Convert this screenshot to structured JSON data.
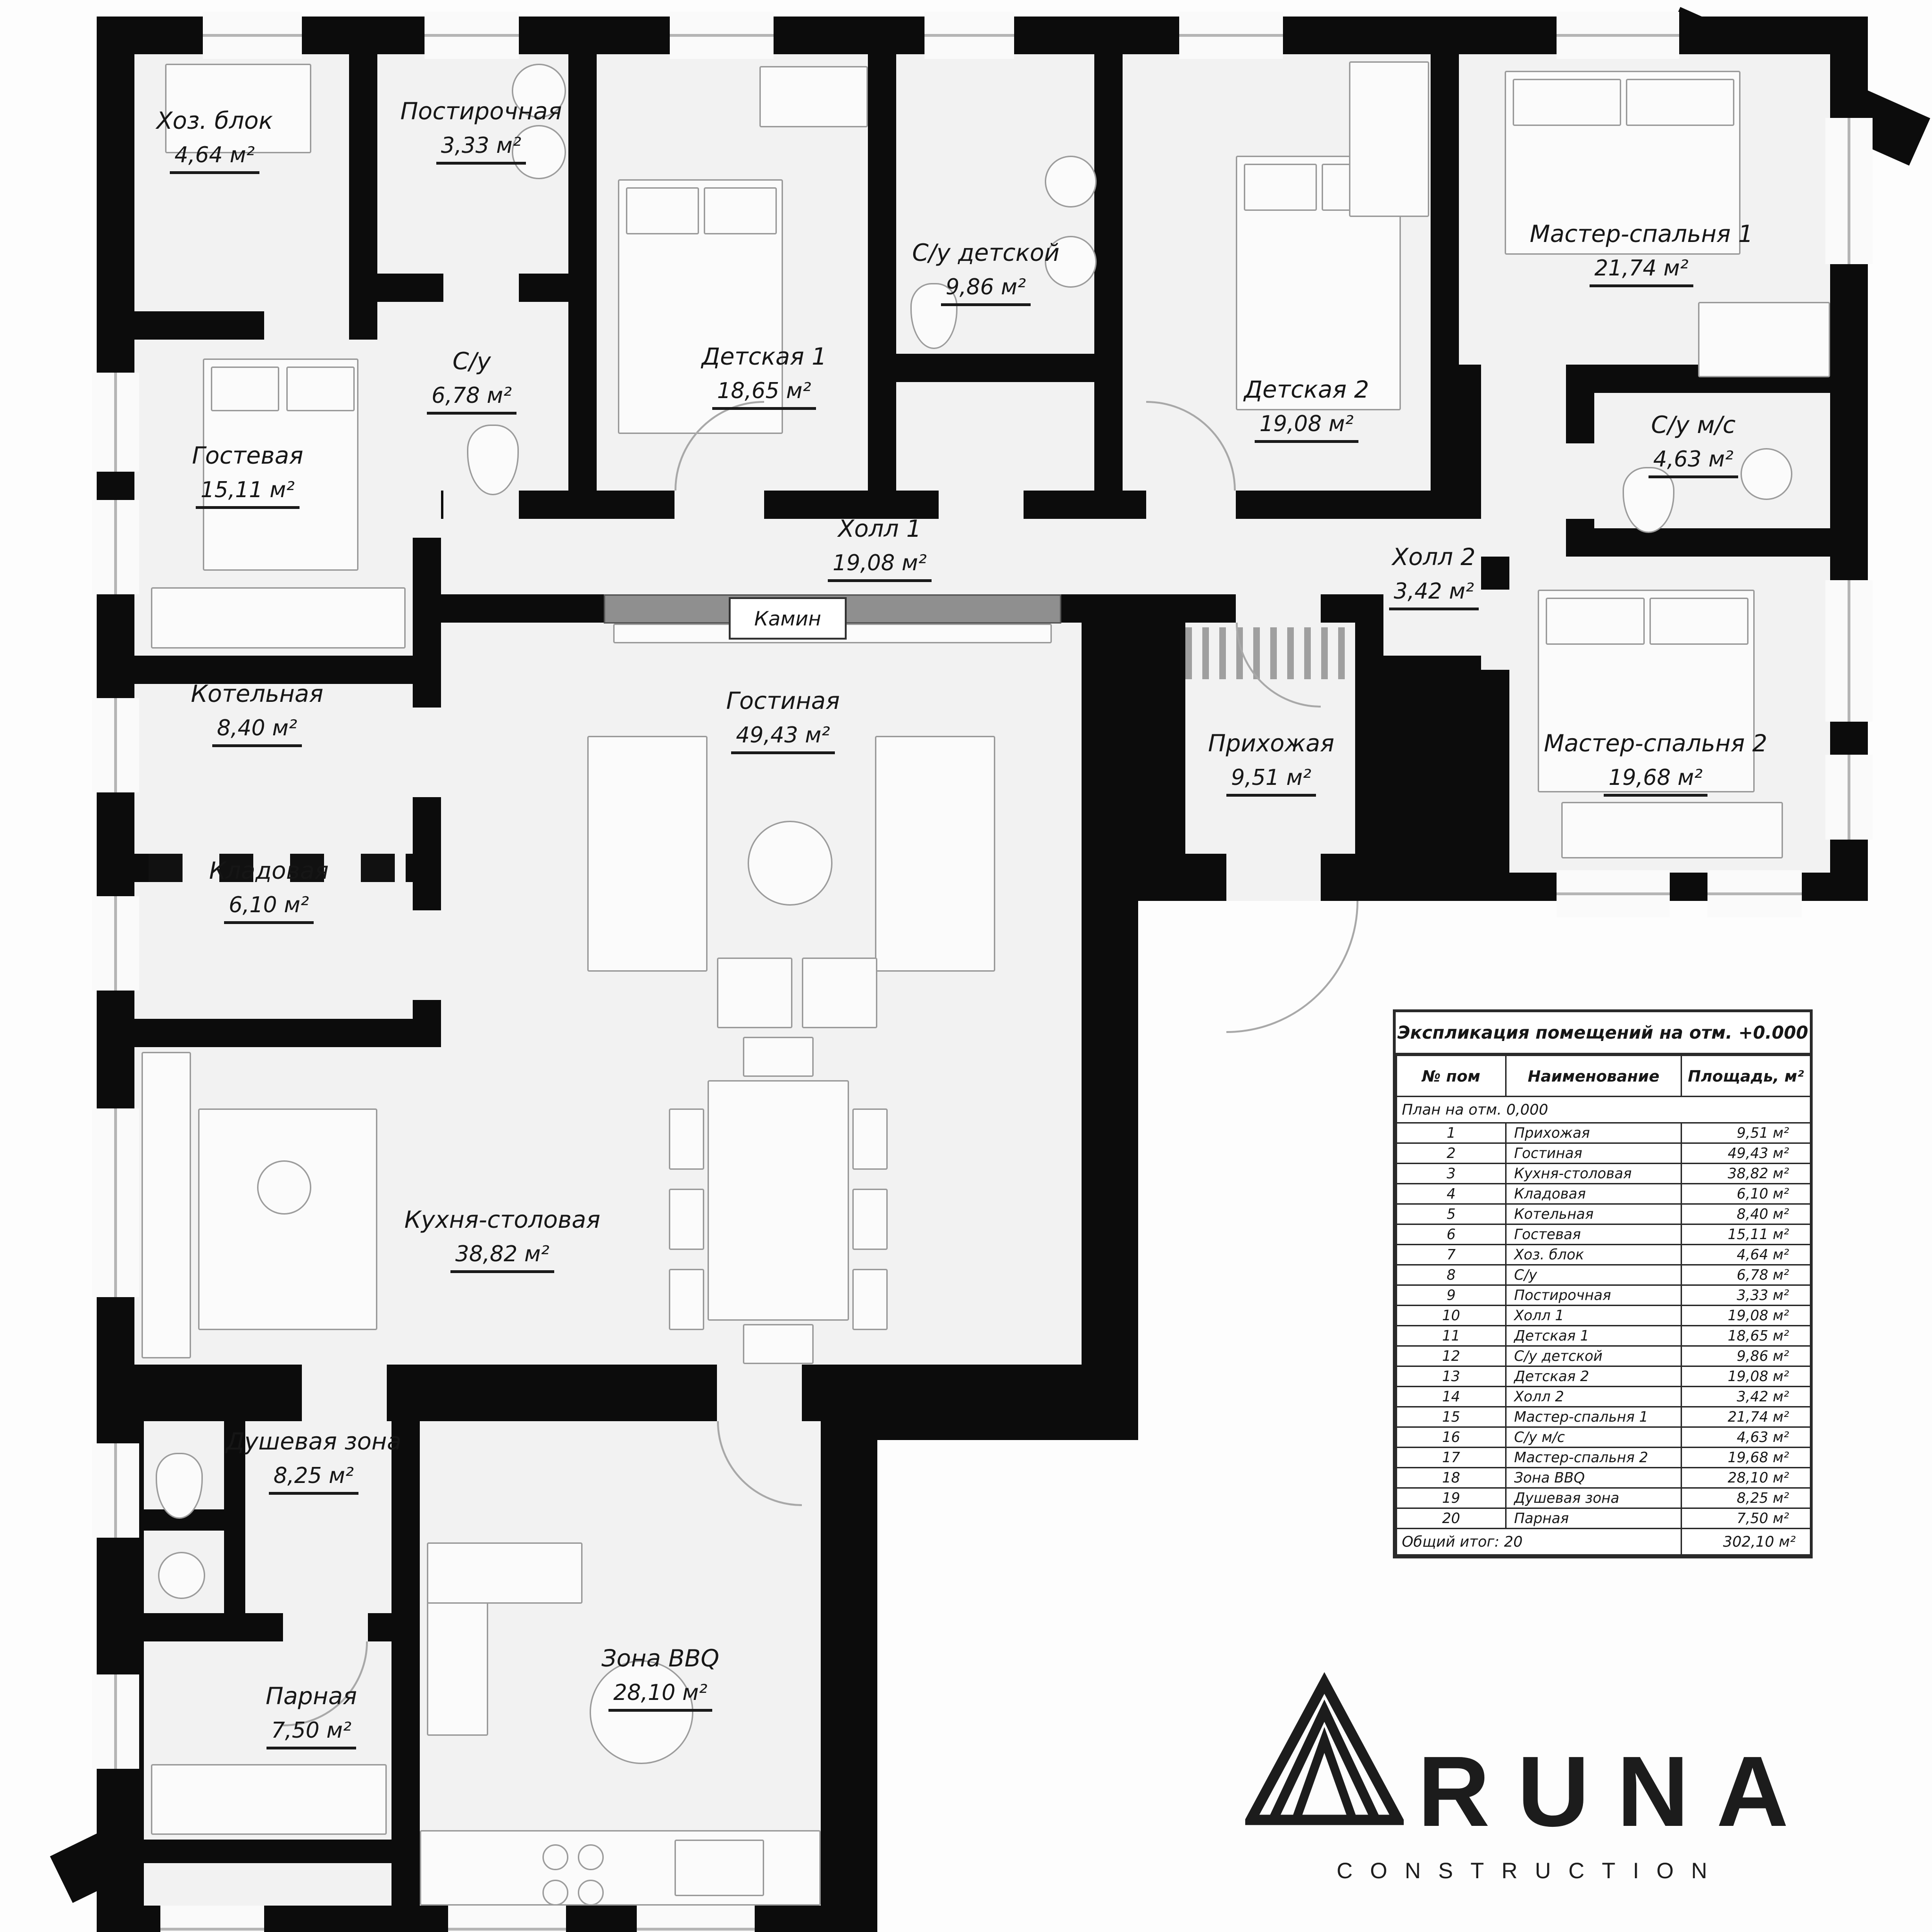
{
  "plan": {
    "fireplace_label": "Камин",
    "rooms": [
      {
        "id": "hoz",
        "name": "Хоз. блок",
        "area": "4,64 м²"
      },
      {
        "id": "post",
        "name": "Постирочная",
        "area": "3,33 м²"
      },
      {
        "id": "su",
        "name": "С/у",
        "area": "6,78 м²"
      },
      {
        "id": "det1",
        "name": "Детская 1",
        "area": "18,65 м²"
      },
      {
        "id": "sudet",
        "name": "С/у детской",
        "area": "9,86 м²"
      },
      {
        "id": "det2",
        "name": "Детская 2",
        "area": "19,08 м²"
      },
      {
        "id": "master1",
        "name": "Мастер-спальня 1",
        "area": "21,74 м²"
      },
      {
        "id": "sums",
        "name": "С/у м/с",
        "area": "4,63 м²"
      },
      {
        "id": "gostevaya",
        "name": "Гостевая",
        "area": "15,11 м²"
      },
      {
        "id": "kotelnaya",
        "name": "Котельная",
        "area": "8,40 м²"
      },
      {
        "id": "kladovaya",
        "name": "Кладовая",
        "area": "6,10 м²"
      },
      {
        "id": "hall1",
        "name": "Холл 1",
        "area": "19,08 м²"
      },
      {
        "id": "hall2",
        "name": "Холл 2",
        "area": "3,42 м²"
      },
      {
        "id": "gostinaya",
        "name": "Гостиная",
        "area": "49,43 м²"
      },
      {
        "id": "prihozhaya",
        "name": "Прихожая",
        "area": "9,51 м²"
      },
      {
        "id": "master2",
        "name": "Мастер-спальня 2",
        "area": "19,68 м²"
      },
      {
        "id": "kuhnya",
        "name": "Кухня-столовая",
        "area": "38,82 м²"
      },
      {
        "id": "dush",
        "name": "Душевая зона",
        "area": "8,25 м²"
      },
      {
        "id": "parnaya",
        "name": "Парная",
        "area": "7,50 м²"
      },
      {
        "id": "bbq",
        "name": "Зона BBQ",
        "area": "28,10 м²"
      }
    ]
  },
  "legend": {
    "title": "Экспликация помещений на отм. +0.000",
    "columns": [
      "№ пом",
      "Наименование",
      "Площадь, м²"
    ],
    "section": "План на отм. 0,000",
    "rows": [
      [
        "1",
        "Прихожая",
        "9,51 м²"
      ],
      [
        "2",
        "Гостиная",
        "49,43 м²"
      ],
      [
        "3",
        "Кухня-столовая",
        "38,82 м²"
      ],
      [
        "4",
        "Кладовая",
        "6,10 м²"
      ],
      [
        "5",
        "Котельная",
        "8,40 м²"
      ],
      [
        "6",
        "Гостевая",
        "15,11 м²"
      ],
      [
        "7",
        "Хоз. блок",
        "4,64 м²"
      ],
      [
        "8",
        "С/у",
        "6,78 м²"
      ],
      [
        "9",
        "Постирочная",
        "3,33 м²"
      ],
      [
        "10",
        "Холл 1",
        "19,08 м²"
      ],
      [
        "11",
        "Детская 1",
        "18,65 м²"
      ],
      [
        "12",
        "С/у детской",
        "9,86 м²"
      ],
      [
        "13",
        "Детская 2",
        "19,08 м²"
      ],
      [
        "14",
        "Холл 2",
        "3,42 м²"
      ],
      [
        "15",
        "Мастер-спальня 1",
        "21,74 м²"
      ],
      [
        "16",
        "С/у м/с",
        "4,63 м²"
      ],
      [
        "17",
        "Мастер-спальня 2",
        "19,68 м²"
      ],
      [
        "18",
        "Зона BBQ",
        "28,10 м²"
      ],
      [
        "19",
        "Душевая зона",
        "8,25 м²"
      ],
      [
        "20",
        "Парная",
        "7,50 м²"
      ]
    ],
    "total_label": "Общий итог: 20",
    "total_value": "302,10 м²"
  },
  "logo": {
    "brand": "RUNA",
    "subtitle": "CONSTRUCTION"
  }
}
